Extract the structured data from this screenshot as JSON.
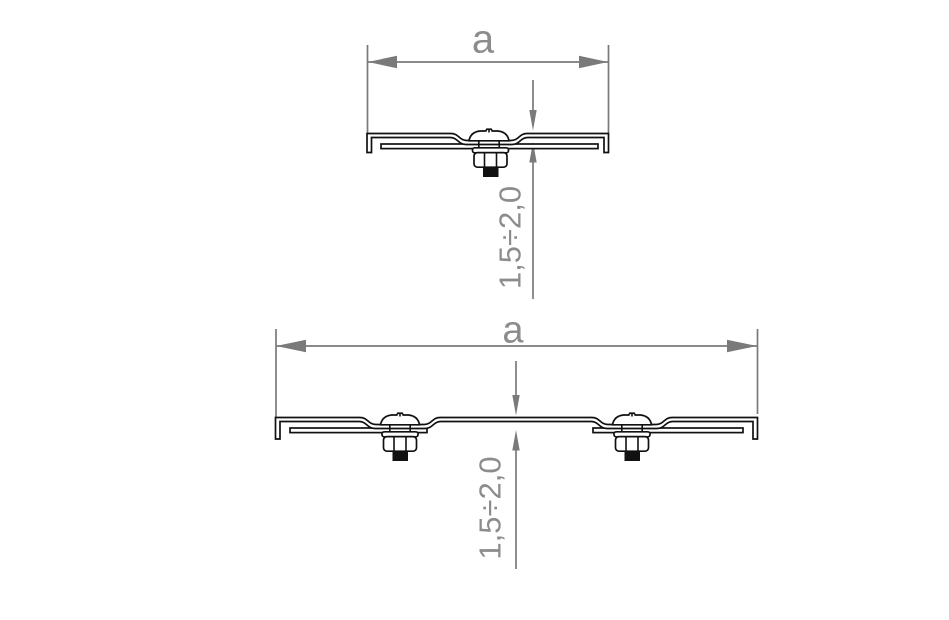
{
  "drawing": {
    "kind": "technical-cross-section",
    "views": {
      "top": {
        "name": "single-screw-splice",
        "width_label": "a",
        "offset_label": "1,5÷2,0",
        "screw_count": 1
      },
      "bottom": {
        "name": "double-screw-splice",
        "width_label": "a",
        "offset_label": "1,5÷2,0",
        "screw_count": 2
      }
    }
  },
  "colors": {
    "background": "#ffffff",
    "drawing_line": "#111111",
    "dimension": "#7a7a7a",
    "dimension_text": "#8c8c8c"
  }
}
